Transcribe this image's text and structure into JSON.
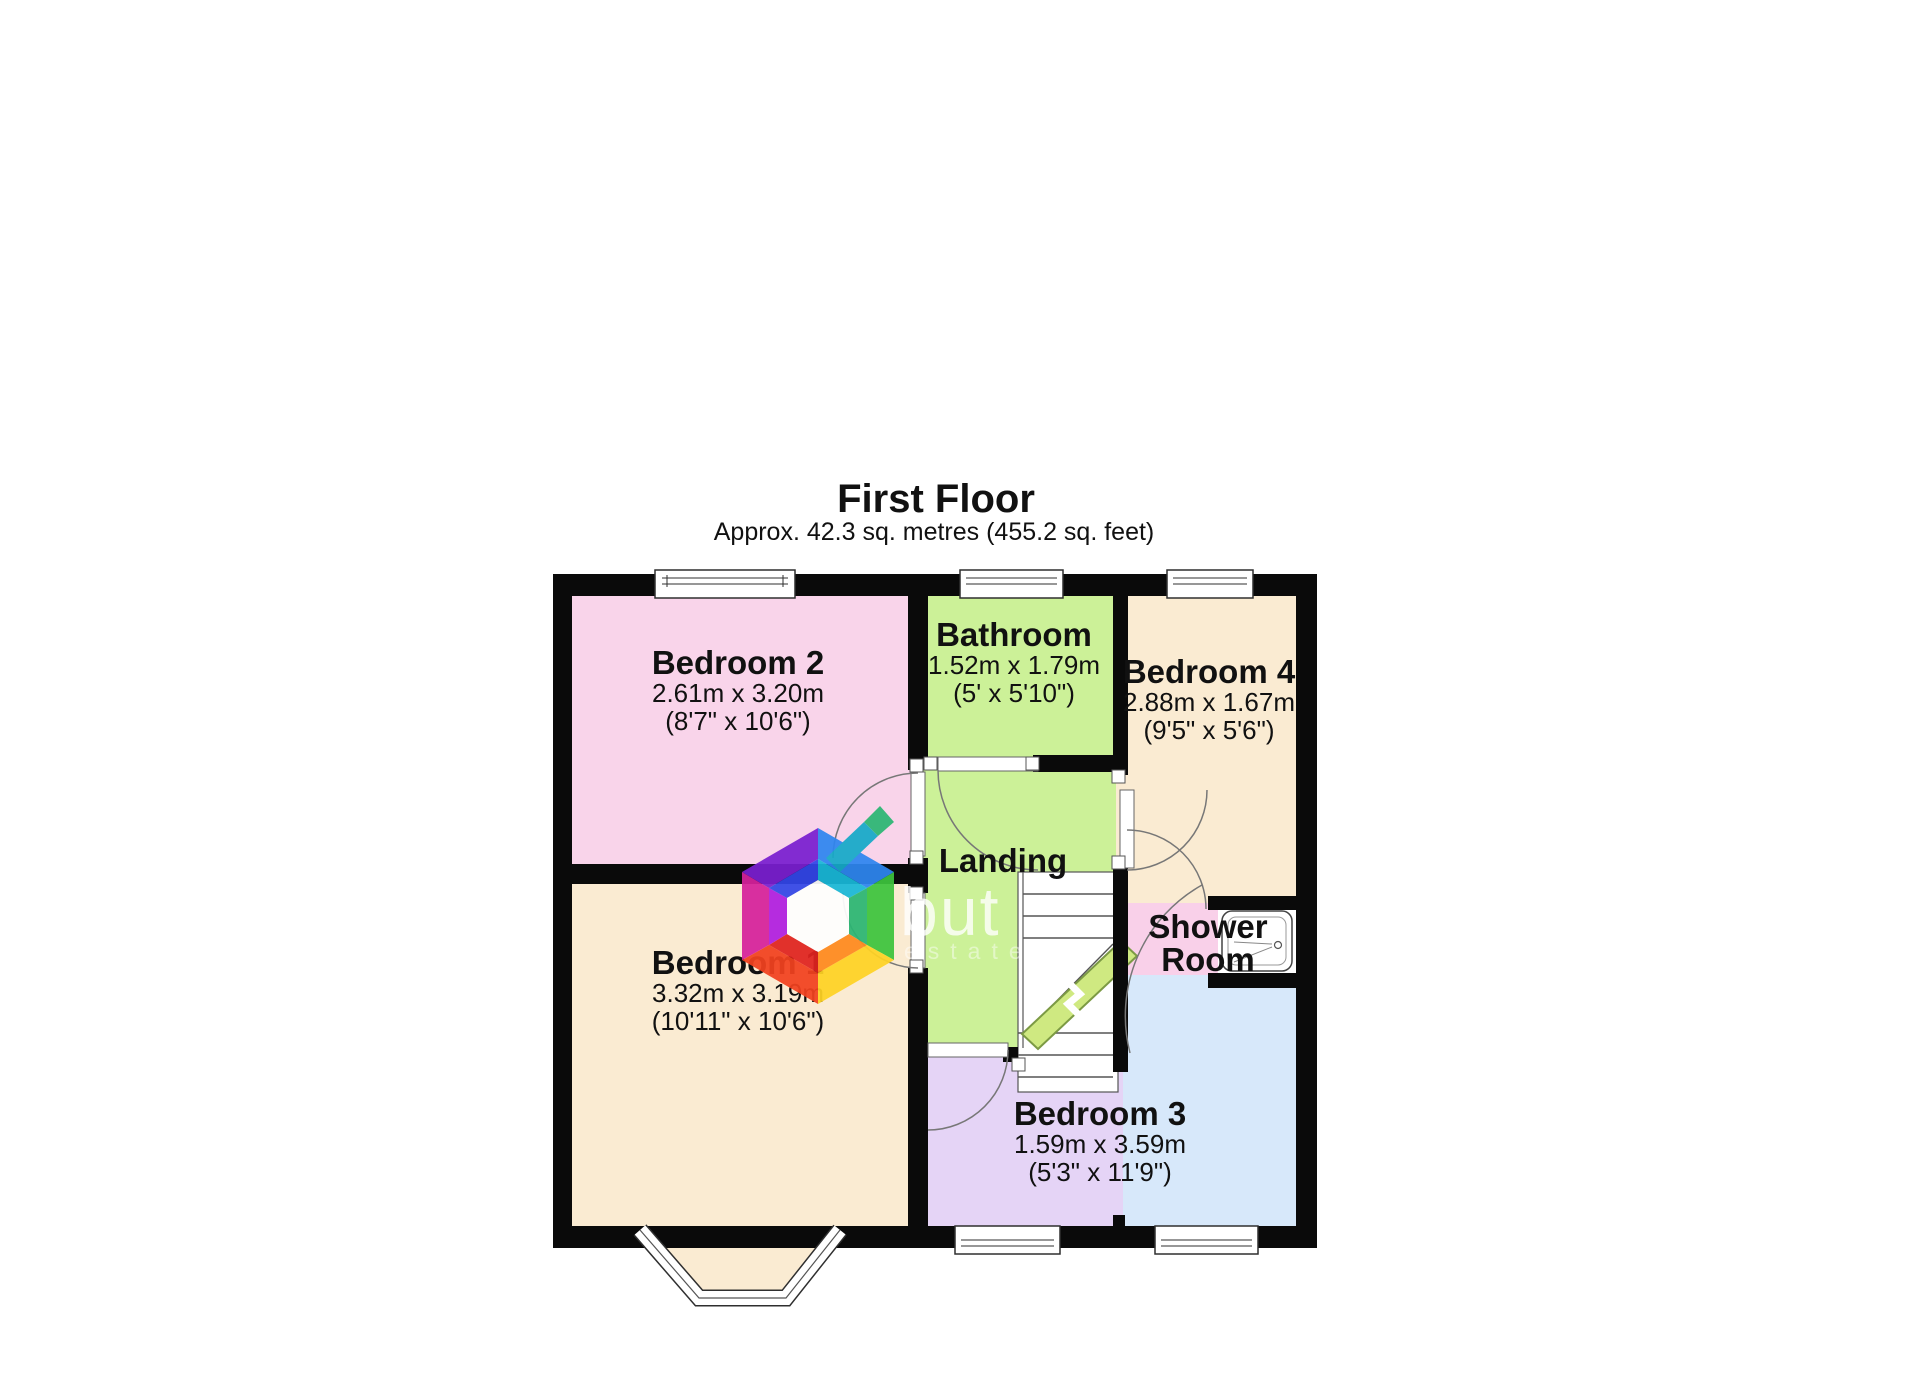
{
  "header": {
    "title": "First Floor",
    "subtitle": "Approx. 42.3 sq. metres (455.2 sq. feet)"
  },
  "rooms": {
    "bedroom2": {
      "name": "Bedroom 2",
      "metric": "2.61m x 3.20m",
      "imperial": "(8'7\" x 10'6\")"
    },
    "bathroom": {
      "name": "Bathroom",
      "metric": "1.52m x 1.79m",
      "imperial": "(5' x 5'10\")"
    },
    "bedroom4": {
      "name": "Bedroom 4",
      "metric": "2.88m x 1.67m",
      "imperial": "(9'5\" x 5'6\")"
    },
    "landing": {
      "name": "Landing"
    },
    "bedroom1": {
      "name": "Bedroom 1",
      "metric": "3.32m x 3.19m",
      "imperial": "(10'11\" x 10'6\")"
    },
    "shower_room": {
      "name_line1": "Shower",
      "name_line2": "Room"
    },
    "bedroom3": {
      "name": "Bedroom 3",
      "metric": "1.59m x 3.59m",
      "imperial": "(5'3\" x 11'9\")"
    }
  },
  "watermark": {
    "brand": "but",
    "subtext": "estate"
  },
  "colors": {
    "wall": "#0a0a0a",
    "bedroom2_fill": "#f9d4ea",
    "bathroom_fill": "#ccf198",
    "landing_fill": "#ccf198",
    "bedroom1_fill": "#faebd2",
    "bedroom4_fill": "#faebd2",
    "bedroom3_fill": "#e5d4f6",
    "bedroom3_blue_fill": "#d7e8fa",
    "shower_room_fill": "#f9d0e9",
    "stairs_arrow": "#cfe981"
  }
}
